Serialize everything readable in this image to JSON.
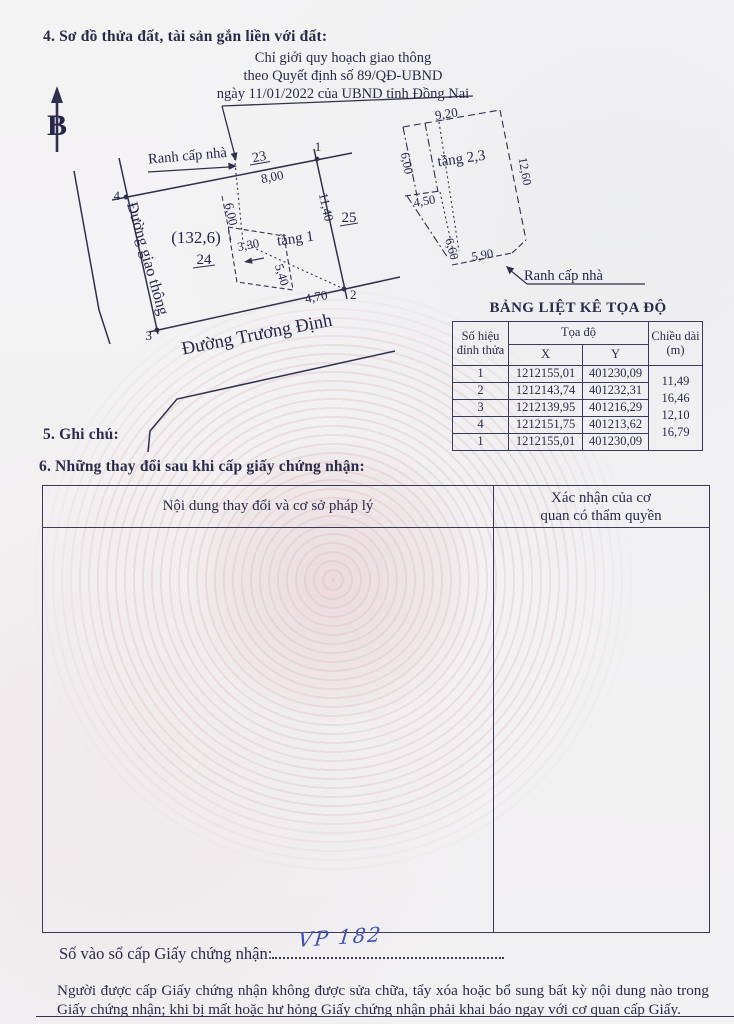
{
  "document": {
    "section4_title": "4. Sơ đồ thửa đất, tài sản gắn liền với đất:",
    "planning_note_lines": [
      "Chỉ giới quy hoạch giao thông",
      "theo Quyết định số 89/QĐ-UBND",
      "ngày 11/01/2022 của UBND tỉnh Đồng Nai"
    ],
    "section5_title": "5. Ghi chú:",
    "section6_title": "6. Những thay đổi sau khi cấp giấy chứng nhận:",
    "registry_label": "Số vào sổ cấp Giấy chứng nhận:",
    "registry_number_handwritten": "VP 182",
    "footer_note": "Người được cấp Giấy chứng nhận không được sửa chữa, tẩy xóa hoặc bổ sung bất kỳ nội dung nào trong Giấy chứng nhận; khi bị mất hoặc hư hỏng Giấy chứng nhận phải khai báo ngay với cơ quan cấp Giấy."
  },
  "diagram": {
    "north_label": "B",
    "setback_label_left": "Ranh cấp nhà",
    "setback_label_right": "Ranh cấp nhà",
    "parcel_23": "23",
    "parcel_24": "24",
    "parcel_25": "25",
    "area_label": "(132,6)",
    "floor1_label": "tầng 1",
    "floor23_label": "tầng 2,3",
    "corner_1": "1",
    "corner_2": "2",
    "corner_3": "3",
    "corner_4": "4",
    "len_top": "8,00",
    "len_left_inner": "6,00",
    "len_right": "11,40",
    "len_3_30": "3,30",
    "len_5_40": "5,40",
    "len_4_70": "4,70",
    "street_bottom": "Đường Trương Định",
    "street_left": "Đường giao thông",
    "b_9_20": "9,20",
    "b_6_00": "6,00",
    "b_12_60": "12,60",
    "b_4_50": "4,50",
    "b_6_60": "6,60",
    "b_5_90": "5,90"
  },
  "coord_table": {
    "title": "BẢNG LIỆT KÊ TỌA ĐỘ",
    "col_point": "Số hiệu đỉnh thửa",
    "col_coords": "Tọa độ",
    "col_x": "X",
    "col_y": "Y",
    "col_length_lines": [
      "Chiều dài",
      "(m)"
    ],
    "rows": [
      {
        "point": "1",
        "x": "1212155,01",
        "y": "401230,09"
      },
      {
        "point": "2",
        "x": "1212143,74",
        "y": "401232,31"
      },
      {
        "point": "3",
        "x": "1212139,95",
        "y": "401216,29"
      },
      {
        "point": "4",
        "x": "1212151,75",
        "y": "401213,62"
      },
      {
        "point": "1",
        "x": "1212155,01",
        "y": "401230,09"
      }
    ],
    "lengths": [
      "11,49",
      "16,46",
      "12,10",
      "16,79"
    ]
  },
  "changes_table": {
    "col_content": "Nội dung thay đổi và cơ sở pháp lý",
    "col_confirm_lines": [
      "Xác nhận của cơ",
      "quan có thẩm quyền"
    ]
  },
  "colors": {
    "ink": "#2a2a4a",
    "handwriting_blue": "#4050b0",
    "watermark_pink": "#d6a0a0"
  }
}
